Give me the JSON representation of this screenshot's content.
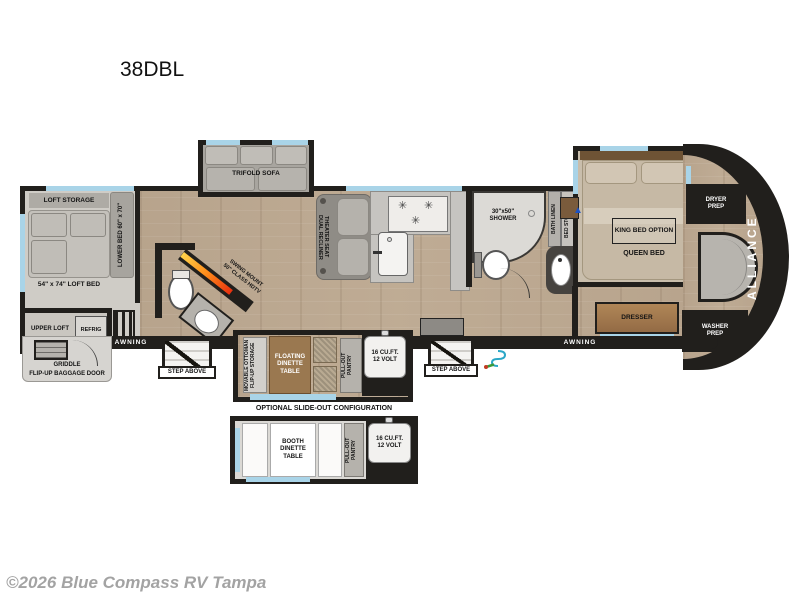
{
  "header": {
    "model": "38DBL"
  },
  "footer": {
    "watermark": "©2026 Blue Compass RV Tampa"
  },
  "colors": {
    "wall": "#211f1c",
    "floor_wood": "#c0ad96",
    "window_accent": "#a9d4e8",
    "fireplace_gradient": [
      "#ffd24a",
      "#ff8c1a",
      "#e8300f"
    ],
    "brand_text": "#ffffff",
    "exterior_shower": "#2ba7c7",
    "tv_marker_blue": "#1b52c4"
  },
  "icons": {
    "burner_glyph": "✳",
    "tv_marker_glyph": "▲"
  },
  "plan": {
    "loft": {
      "storage": "LOFT STORAGE",
      "bed": "54\" x 74\" LOFT BED",
      "lower_bed": "LOWER BED 60\" x 70\"",
      "upper": "UPPER LOFT",
      "refrig": "REFRIG"
    },
    "living": {
      "sofa": "TRIFOLD SOFA",
      "theater_line1": "DUAL RECLINER",
      "theater_line2": "THEATER SEAT",
      "tv_line1": "SWING MOUNT",
      "tv_line2": "50\" CLASS HDTV"
    },
    "bath": {
      "shower": "30\"x50\" SHOWER",
      "linen": "BATH LINEN",
      "bed_storage": "BED STORAGE"
    },
    "bedroom": {
      "king": "KING BED OPTION",
      "queen": "QUEEN BED",
      "dresser": "DRESSER"
    },
    "front": {
      "dryer": "DRYER PREP",
      "washer": "WASHER PREP",
      "brand": "ALLIANCE"
    },
    "exterior": {
      "awning1": "AWNING",
      "awning2": "AWNING",
      "step1": "STEP ABOVE",
      "step2": "STEP ABOVE",
      "griddle": "GRIDDLE",
      "baggage": "FLIP-UP BAGGAGE DOOR"
    },
    "dinette": {
      "ottoman1": "MOVABLE OTTOMAN",
      "ottoman2": "FLIP-UP STORAGE",
      "table": "FLOATING DINETTE TABLE",
      "pantry1": "PULL-OUT",
      "pantry2": "PANTRY",
      "fridge1": "16 CU.FT.",
      "fridge2": "12 VOLT"
    },
    "optional": {
      "title": "OPTIONAL SLIDE-OUT CONFIGURATION",
      "booth": "BOOTH DINETTE TABLE",
      "pantry1": "PULL-OUT",
      "pantry2": "PANTRY",
      "fridge1": "16 CU.FT.",
      "fridge2": "12 VOLT"
    }
  }
}
